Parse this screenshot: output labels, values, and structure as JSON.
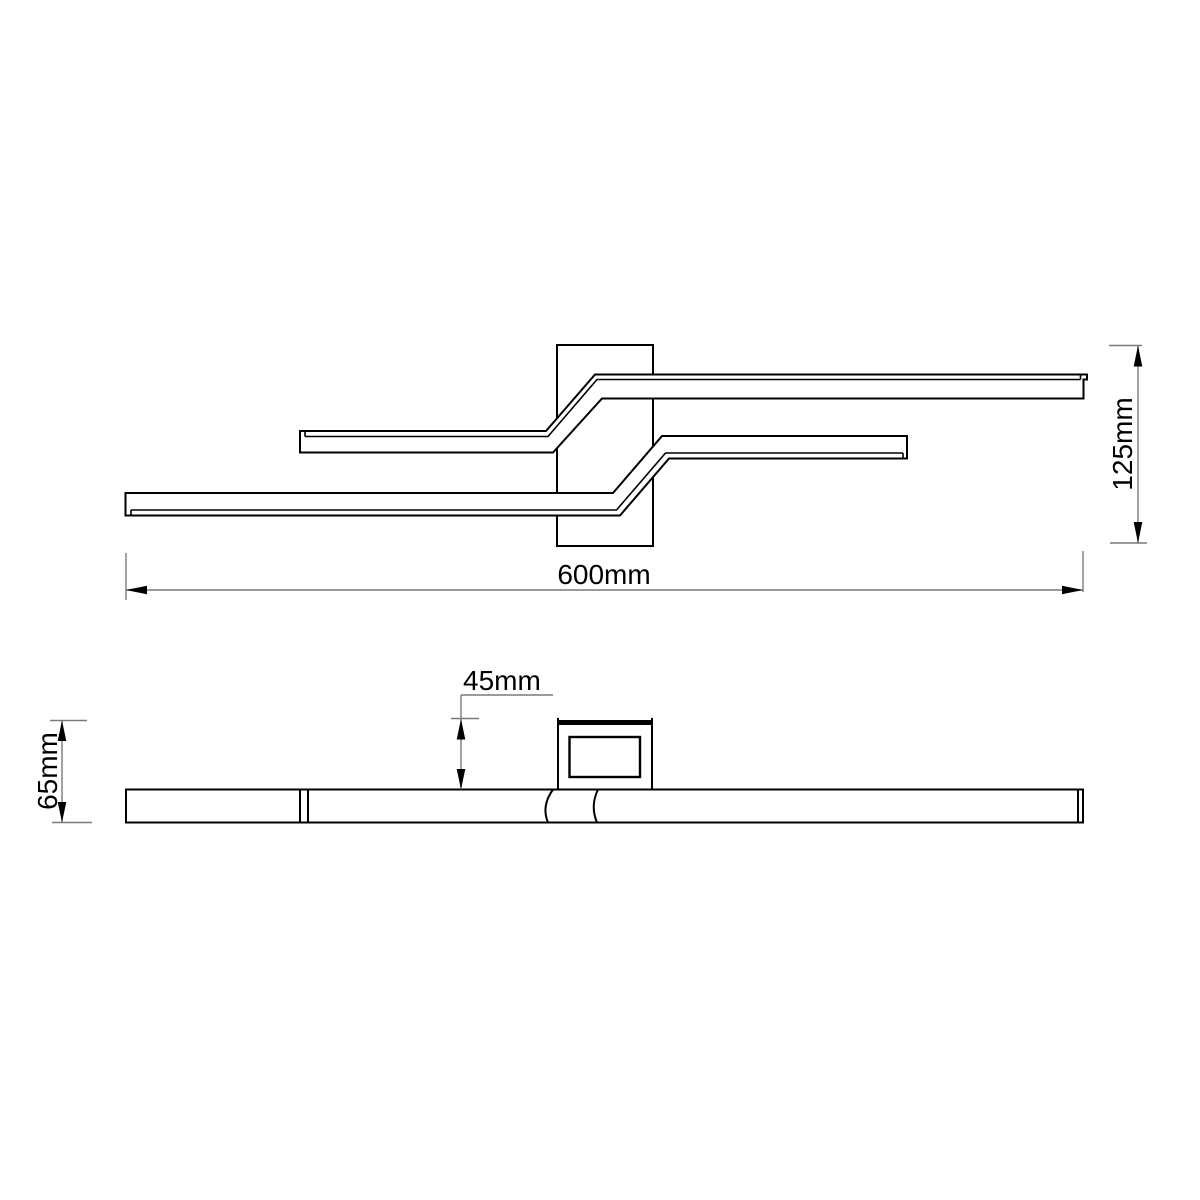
{
  "colors": {
    "background": "#ffffff",
    "outline": "#000000",
    "dimension_lines": "#7a7a7a",
    "text": "#000000"
  },
  "top_view": {
    "width_label": "600mm",
    "height_label": "125mm"
  },
  "side_view": {
    "depth_label": "45mm",
    "height_label": "65mm"
  }
}
